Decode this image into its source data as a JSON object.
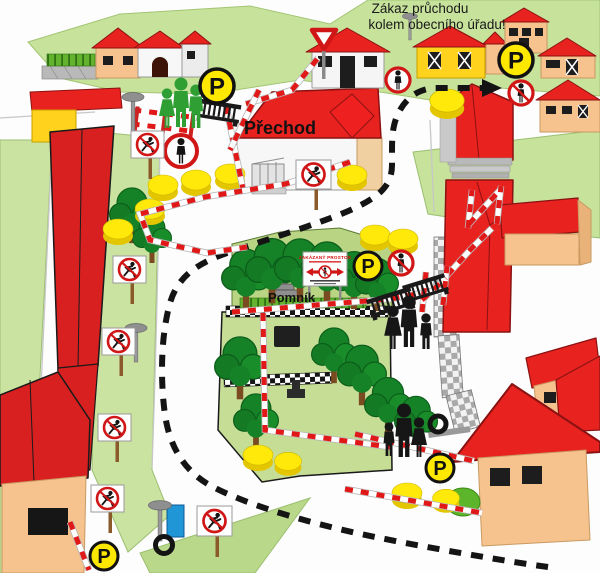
{
  "banner": {
    "line1": "Zákaz průchodu",
    "line2": "kolem obecního úřadu!"
  },
  "labels": {
    "crossing": "Přechod",
    "monument": "Pomník"
  },
  "signs": {
    "parking_letter": "P",
    "forbidden_area_title": "ZAKÁZANÝ PROSTOR"
  },
  "icons": {
    "parking-sign": "yellow circle, black border, letter P",
    "no-pedestrians-sign": "red ring with black standing person",
    "no-pedestrians-slashed-sign": "red ring, black standing person, red slash",
    "no-running-sign": "white board on post, red ring, running person, red slash",
    "yield-sign": "red bordered inverted triangle on post",
    "forbidden-area-sign": "white board, red title, left-right red arrows, crossed pedestrian",
    "barrier-tape": "red-white striped police tape",
    "metal-barrier": "portable crowd fence",
    "detour-path": "black dashed route with arrow",
    "street-lamp": "grey mushroom lamp",
    "tree": "green deciduous tree",
    "bush": "yellow shrub"
  },
  "colors": {
    "roof_red": "#e8221f",
    "wall_tan": "#f6c28e",
    "wall_yellow": "#ffd21e",
    "grass_hill": "#c6e29b",
    "park_green": "#c6dd95",
    "bush_yellow": "#ffe90a",
    "tape_red": "#e01818",
    "sign_red": "#d01616",
    "parking_yellow": "#ffe800",
    "route_black": "#141414",
    "people_green": "#2f9e33",
    "people_black": "#161616"
  }
}
